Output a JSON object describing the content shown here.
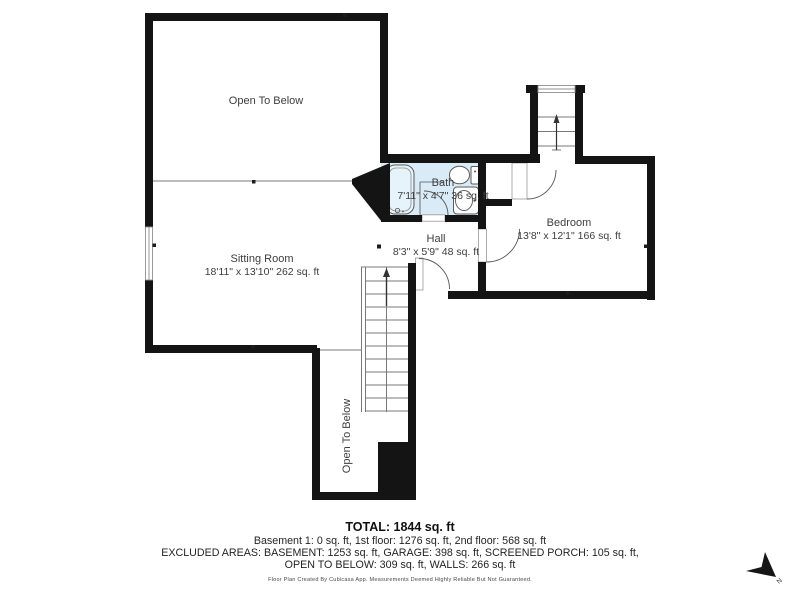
{
  "floorplan": {
    "rooms": {
      "open_to_below_top": {
        "label": "Open To Below"
      },
      "sitting_room": {
        "label": "Sitting Room",
        "dims": "18'11\" x 13'10\" 262 sq. ft"
      },
      "bath": {
        "label": "Bath",
        "dims": "7'11\" x 4'7\" 36 sq. ft"
      },
      "hall": {
        "label": "Hall",
        "dims": "8'3\" x 5'9\" 48 sq. ft"
      },
      "bedroom": {
        "label": "Bedroom",
        "dims": "13'8\" x 12'1\" 166 sq. ft"
      },
      "open_to_below_bottom": {
        "label": "Open To Below"
      }
    },
    "north_label": "N",
    "colors": {
      "wall": "#141414",
      "bath_fill": "#d9ebf7",
      "fixture_stroke": "#5a5a5a",
      "thin_line": "#787878",
      "label_text": "#3d3d3d"
    }
  },
  "footer": {
    "total": "TOTAL: 1844 sq. ft",
    "line1": "Basement 1: 0 sq. ft, 1st floor: 1276 sq. ft, 2nd floor: 568 sq. ft",
    "line2": "EXCLUDED AREAS: BASEMENT: 1253 sq. ft, GARAGE: 398 sq. ft, SCREENED PORCH: 105 sq. ft,",
    "line3": "OPEN TO BELOW: 309 sq. ft, WALLS: 266 sq. ft",
    "disclaimer": "Floor Plan Created By Cubicasa App. Measurements Deemed Highly Reliable But Not Guaranteed."
  }
}
